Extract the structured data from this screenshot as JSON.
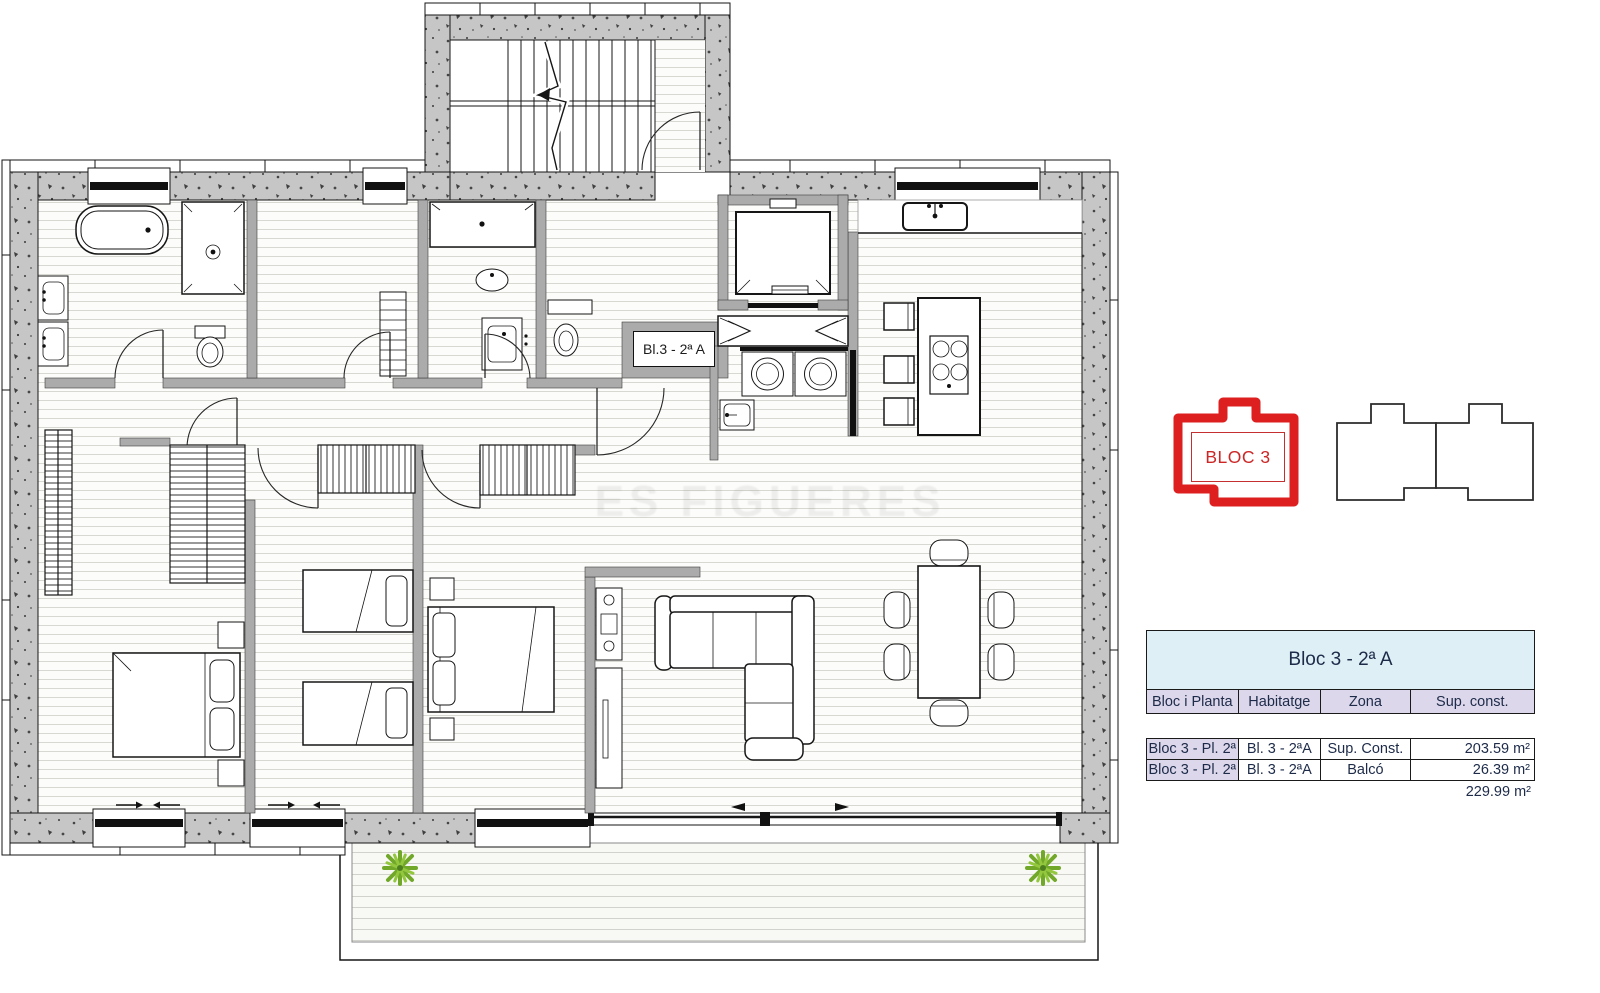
{
  "plan": {
    "unit_label": "Bl.3 - 2ª A",
    "watermark": "ES FIGUERES",
    "badge": {
      "label": "BLOC 3",
      "color": "#cc2626"
    },
    "colors": {
      "wall_gray": "#c6c6c6",
      "plant_green": "#76a32f",
      "accent_red": "#cc2626"
    }
  },
  "legend_table": {
    "title": "Bloc 3 - 2ª A",
    "columns": [
      "Bloc i Planta",
      "Habitatge",
      "Zona",
      "Sup. const."
    ],
    "rows": [
      {
        "bloc": "Bloc 3 - Pl. 2ª",
        "habitatge": "Bl. 3 - 2ªA",
        "zona": "Sup. Const.",
        "sup": "203.59 m²"
      },
      {
        "bloc": "Bloc 3 - Pl. 2ª",
        "habitatge": "Bl. 3 - 2ªA",
        "zona": "Balcó",
        "sup": "26.39 m²"
      }
    ],
    "total": "229.99 m²",
    "colors": {
      "title_bg": "#def0f6",
      "header_bg": "#dcd7eb",
      "text": "#1d2b49"
    }
  }
}
